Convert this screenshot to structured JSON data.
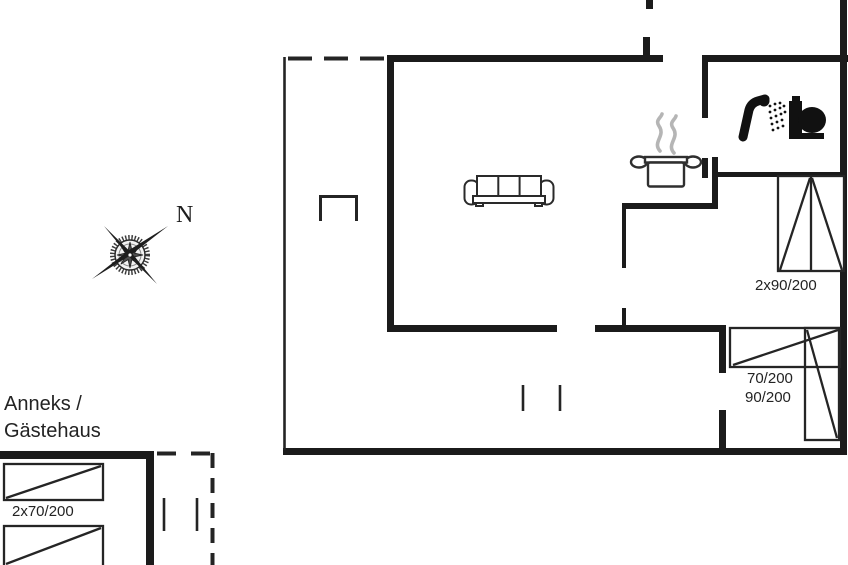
{
  "page": {
    "background_color": "#ffffff",
    "line_color": "#1b1b1b",
    "steam_color": "#b5b5b5"
  },
  "compass": {
    "north_label": "N"
  },
  "annex": {
    "title_line1": "Anneks /",
    "title_line2": "Gästehaus",
    "bed_label": "2x70/200"
  },
  "main_house": {
    "bedroom_top_right": {
      "bed_label": "2x90/200"
    },
    "bedroom_bottom_right": {
      "bed_labels": [
        "70/200",
        "90/200"
      ]
    }
  },
  "icons": {
    "compass": "compass-rose-icon",
    "sofa": "sofa-icon",
    "cooking_pot": "cooking-pot-icon",
    "steam": "steam-icon",
    "shower": "shower-icon",
    "toilet": "toilet-icon",
    "bed": "bed-icon"
  }
}
